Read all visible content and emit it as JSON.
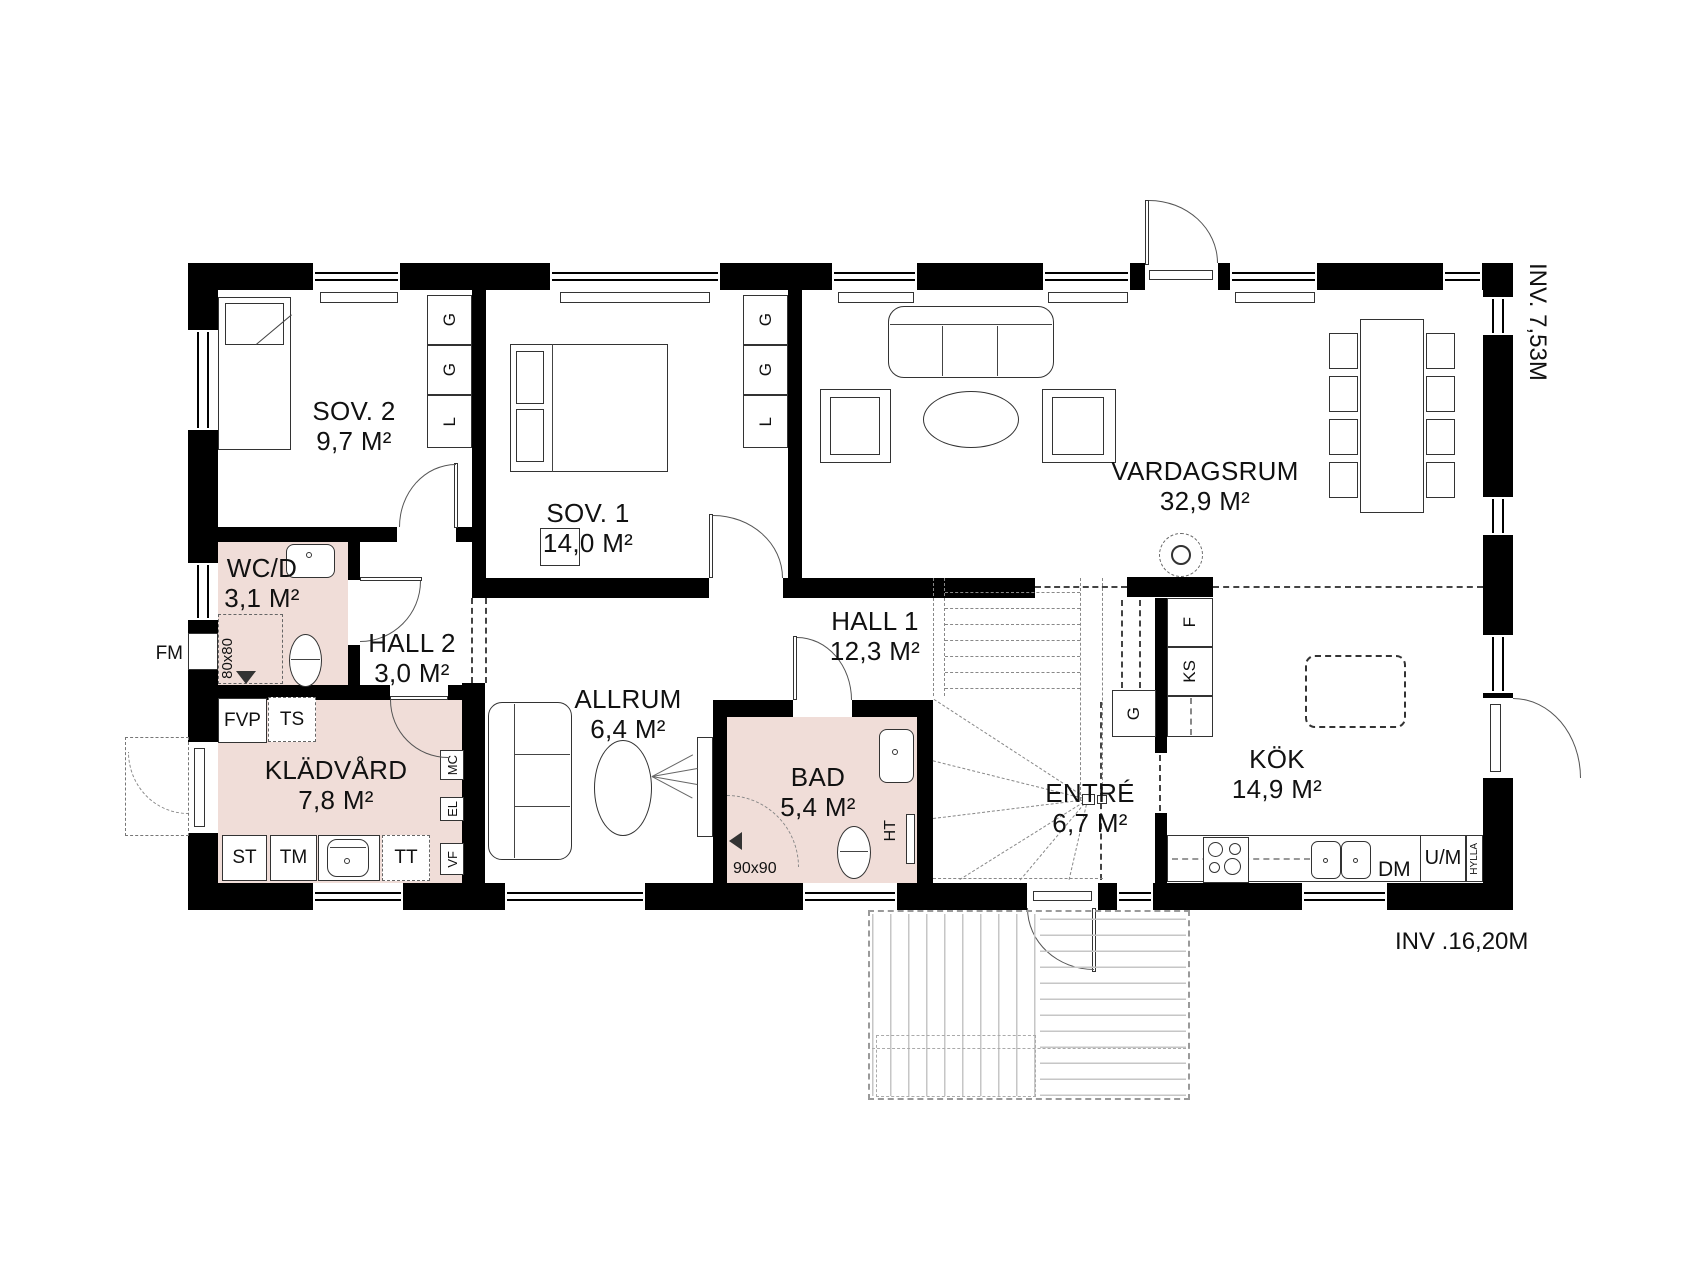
{
  "rooms": {
    "sov2": {
      "name": "SOV. 2",
      "area": "9,7 M²"
    },
    "sov1": {
      "name": "SOV. 1",
      "area": "14,0 M²"
    },
    "vardagsrum": {
      "name": "VARDAGSRUM",
      "area": "32,9 M²"
    },
    "wcd": {
      "name": "WC/D",
      "area": "3,1 M²"
    },
    "hall2": {
      "name": "HALL 2",
      "area": "3,0 M²"
    },
    "kladvard": {
      "name": "KLÄDVÅRD",
      "area": "7,8 M²"
    },
    "allrum": {
      "name": "ALLRUM",
      "area": "6,4 M²"
    },
    "hall1": {
      "name": "HALL 1",
      "area": "12,3 M²"
    },
    "bad": {
      "name": "BAD",
      "area": "5,4 M²"
    },
    "entre": {
      "name": "ENTRÉ",
      "area": "6,7 M²"
    },
    "kok": {
      "name": "KÖK",
      "area": "14,9 M²"
    }
  },
  "fixtures": {
    "g": "G",
    "l": "L",
    "f": "F",
    "ks": "KS",
    "fvp": "FVP",
    "ts": "TS",
    "st": "ST",
    "tm": "TM",
    "tt": "TT",
    "mc": "MC",
    "el": "EL",
    "vf": "VF",
    "fm": "FM",
    "ht": "HT",
    "dm": "DM",
    "um": "U/M",
    "hylla": "HYLLA",
    "shower_80": "80x80",
    "shower_90": "90x90"
  },
  "dimensions": {
    "interior_depth": "INV. 7,53M",
    "interior_width": "INV .16,20M"
  },
  "colors": {
    "wet_room_fill": "#F0DDD8",
    "wall": "#000000",
    "background": "#FFFFFF"
  }
}
